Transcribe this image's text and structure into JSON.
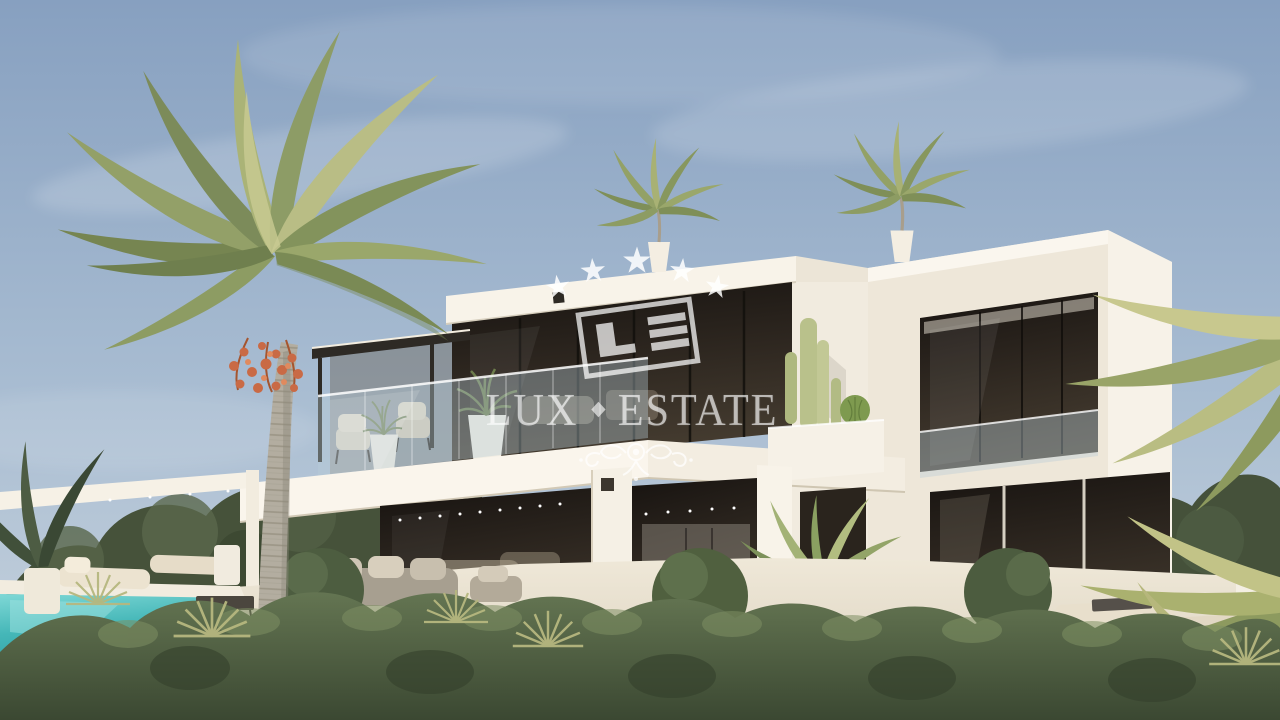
{
  "watermark": {
    "brand": "LUX·ESTATE",
    "brand_left": "LUX",
    "brand_right": "ESTATE",
    "monogram": "LE",
    "stars_count": 5,
    "color": "#ffffff"
  },
  "scene": {
    "type": "architectural-exterior-3d-render",
    "subject": "modern two-story luxury villa",
    "elements": [
      "flat-roof white villa with two volumes",
      "floor-to-ceiling dark tinted glazing",
      "glass balustrades on upper terrace and balcony",
      "rooftop palms in white planters",
      "tall cactus planter between volumes",
      "open ground-floor lounge and dining terrace",
      "areca palm in white tapered pot",
      "turquoise swimming pool with white coping",
      "outdoor loungers, sofas and coffee tables",
      "tall royal palm with orange seed clusters",
      "foreground clipped hedge and fan palms",
      "arching yellow-green palm fronds at right edge",
      "dense dark tree line behind the terrace",
      "string lights under the slab edges"
    ],
    "palette": {
      "sky_top": "#8ba5c4",
      "sky_horizon": "#c6d2dd",
      "villa_white": "#f7f2e8",
      "villa_cream_shadow": "#e6ddcc",
      "glazing_dark": "#241f19",
      "glass_tint": "#b8cdd8",
      "pool_water": "#45b7b8",
      "hedge_green": "#5d6e4e",
      "tree_dark_green": "#47533b",
      "palm_frond_green": "#8d9c66",
      "palm_frond_yellow": "#b9bd85",
      "palm_trunk_grey": "#b3ada0",
      "seed_cluster_orange": "#c96a45",
      "terrace_floor": "#e7dfcf"
    }
  }
}
